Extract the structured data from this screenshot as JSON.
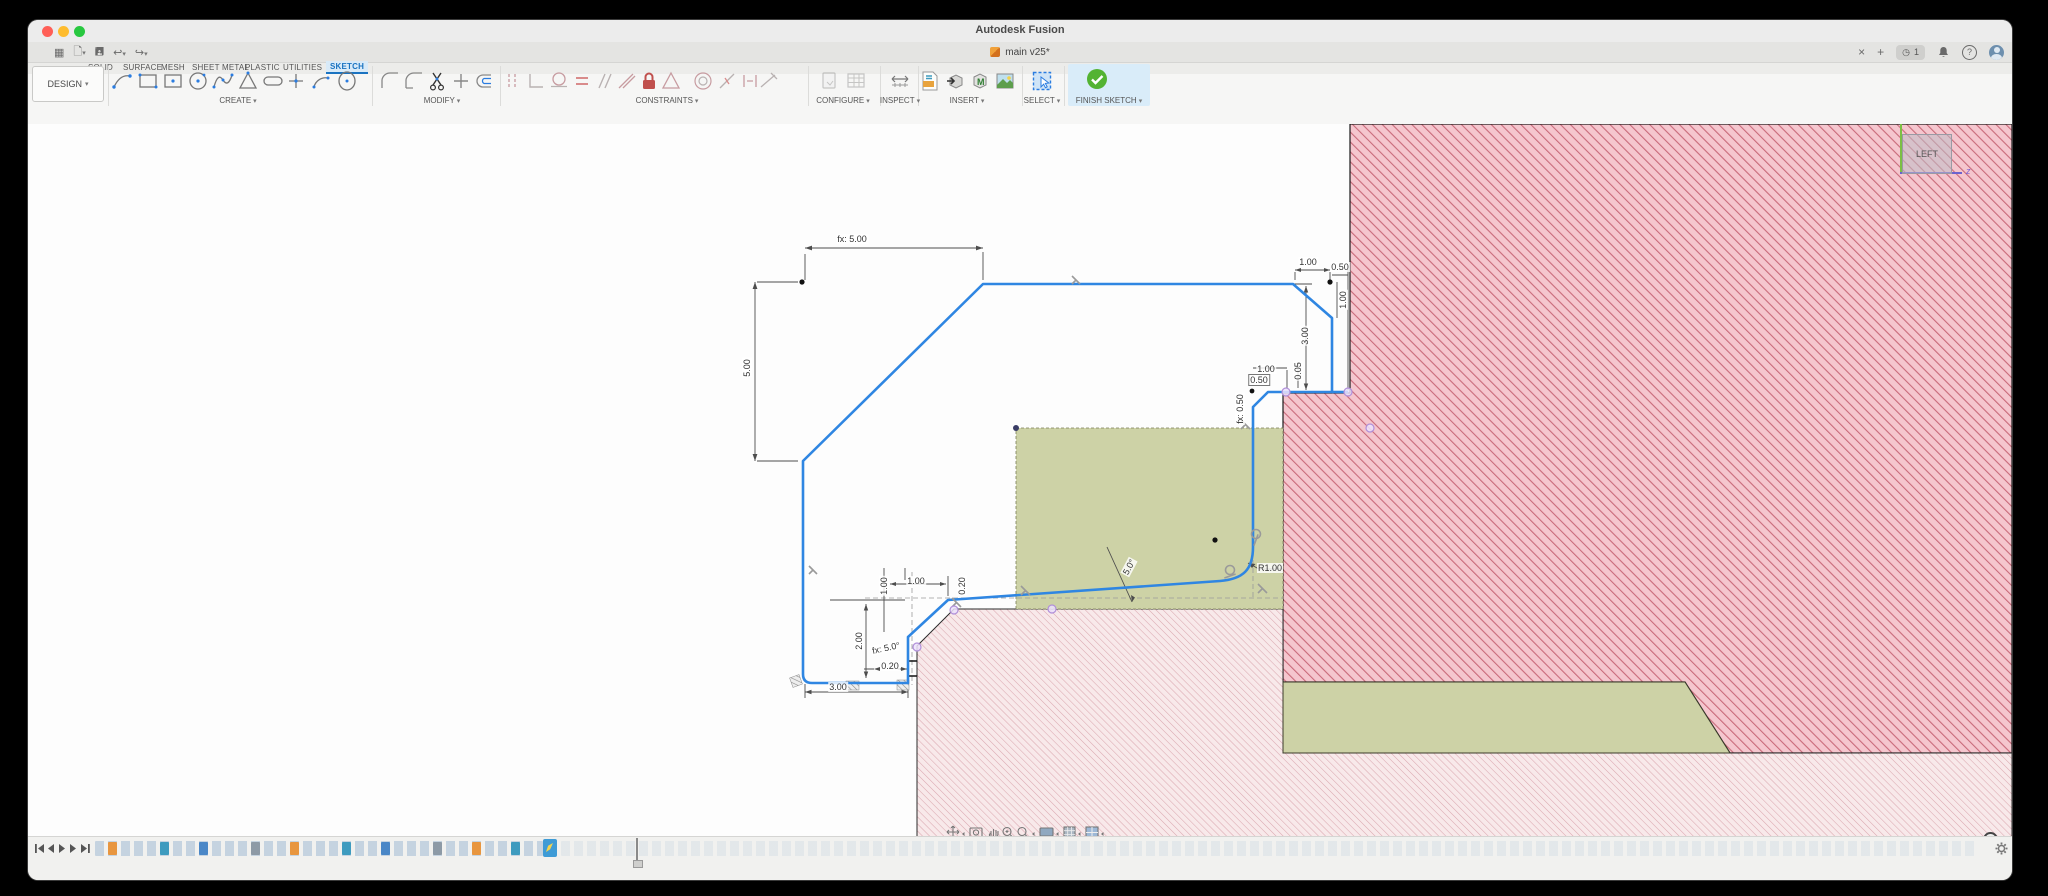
{
  "titlebar": {
    "title": "Autodesk Fusion"
  },
  "document_tab": {
    "label": "main v25*"
  },
  "icons": {
    "caret": "▾",
    "close": "×",
    "plus": "+",
    "undo": "↩",
    "redo": "↪",
    "question": "?",
    "clock": "◷",
    "grid": "▦",
    "notification_count": "1"
  },
  "ribbon": {
    "env_button": "DESIGN",
    "tabs": [
      {
        "label": "SOLID"
      },
      {
        "label": "SURFACE"
      },
      {
        "label": "MESH"
      },
      {
        "label": "SHEET METAL"
      },
      {
        "label": "PLASTIC"
      },
      {
        "label": "UTILITIES"
      },
      {
        "label": "SKETCH",
        "active": true
      }
    ],
    "groups": [
      {
        "label": "CREATE"
      },
      {
        "label": "MODIFY"
      },
      {
        "label": "CONSTRAINTS"
      },
      {
        "label": "CONFIGURE"
      },
      {
        "label": "INSPECT"
      },
      {
        "label": "INSERT"
      },
      {
        "label": "SELECT"
      },
      {
        "label": "FINISH SKETCH"
      }
    ]
  },
  "canvas": {
    "viewcube": {
      "face": "LEFT",
      "axis_label": "z"
    },
    "status": "14 Sketch Curves : Length : 43.705 mm",
    "dims": {
      "d1": "fx: 5.00",
      "d2": "5.00",
      "d3": "1.00",
      "d4": "0.50",
      "d5": "1.00",
      "d6": "3.00",
      "d7": "0.05",
      "d8": "1.00",
      "d9": "0.50",
      "d10": "fx: 0.50",
      "d11": "R1.00",
      "d12": "5.0°",
      "d13": "fx: 5.0°",
      "d14": "2.00",
      "d15": "0.20",
      "d16": "3.00",
      "d17": "1.00",
      "d18": "1.00",
      "d19": "0.20"
    },
    "colors": {
      "sketch_blue": "#2f86e2",
      "hatch_dark_line": "#c96a7a",
      "hatch_dark_bg": "#f5c6ce",
      "hatch_light_line": "#dba8b0",
      "hatch_light_bg": "#f8e9ea",
      "profile_green": "#cdd2a6",
      "select_blue": "#2a7ce0",
      "finish_green": "#53b332"
    }
  }
}
